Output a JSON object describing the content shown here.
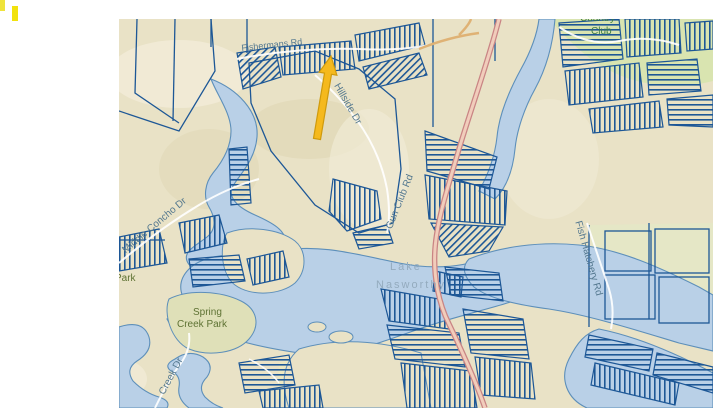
{
  "page": {
    "background": "#ffffff"
  },
  "marks": {
    "bar1_color": "#efe33b",
    "bar2_color": "#f2e20d"
  },
  "map": {
    "colors": {
      "mark1": "#efe33b",
      "mark2": "#f2e20d",
      "land": "#e9e2c6",
      "landlight": "#f2ecd8",
      "landshade": "#ddd4b0",
      "water": "#b9d0e7",
      "shore": "#5d8fba",
      "parcel": "#1d5796",
      "roadcasing": "#c98484",
      "roadfill": "#f1cdbb",
      "roadminor": "#ffffff",
      "roadtan": "#dfb275",
      "green": "#d9e4b0",
      "greenpale": "#e4e7c5",
      "roadlbl": "#54788f",
      "lakelbl": "#94abbe",
      "parklbl": "#5e7233",
      "clublbl": "#3e7d46",
      "arrow": "#f5b91d",
      "arrowedge": "#cf9a0d"
    },
    "labels": {
      "top_road": "Fishermans Rd",
      "hillside": "Hillside Dr",
      "gun_club": "Gun Club Rd",
      "middle_concho": "Middle Concho Dr",
      "lake_line1": "Lake",
      "lake_line2": "Nasworthy",
      "park": "Park",
      "spring_line1": "Spring",
      "spring_line2": "Creek Park",
      "creek_dr": "Creek Dr",
      "fish_hatchery": "Fish Hatchery Rd",
      "country_line1": "Country",
      "country_line2": "Club"
    }
  }
}
